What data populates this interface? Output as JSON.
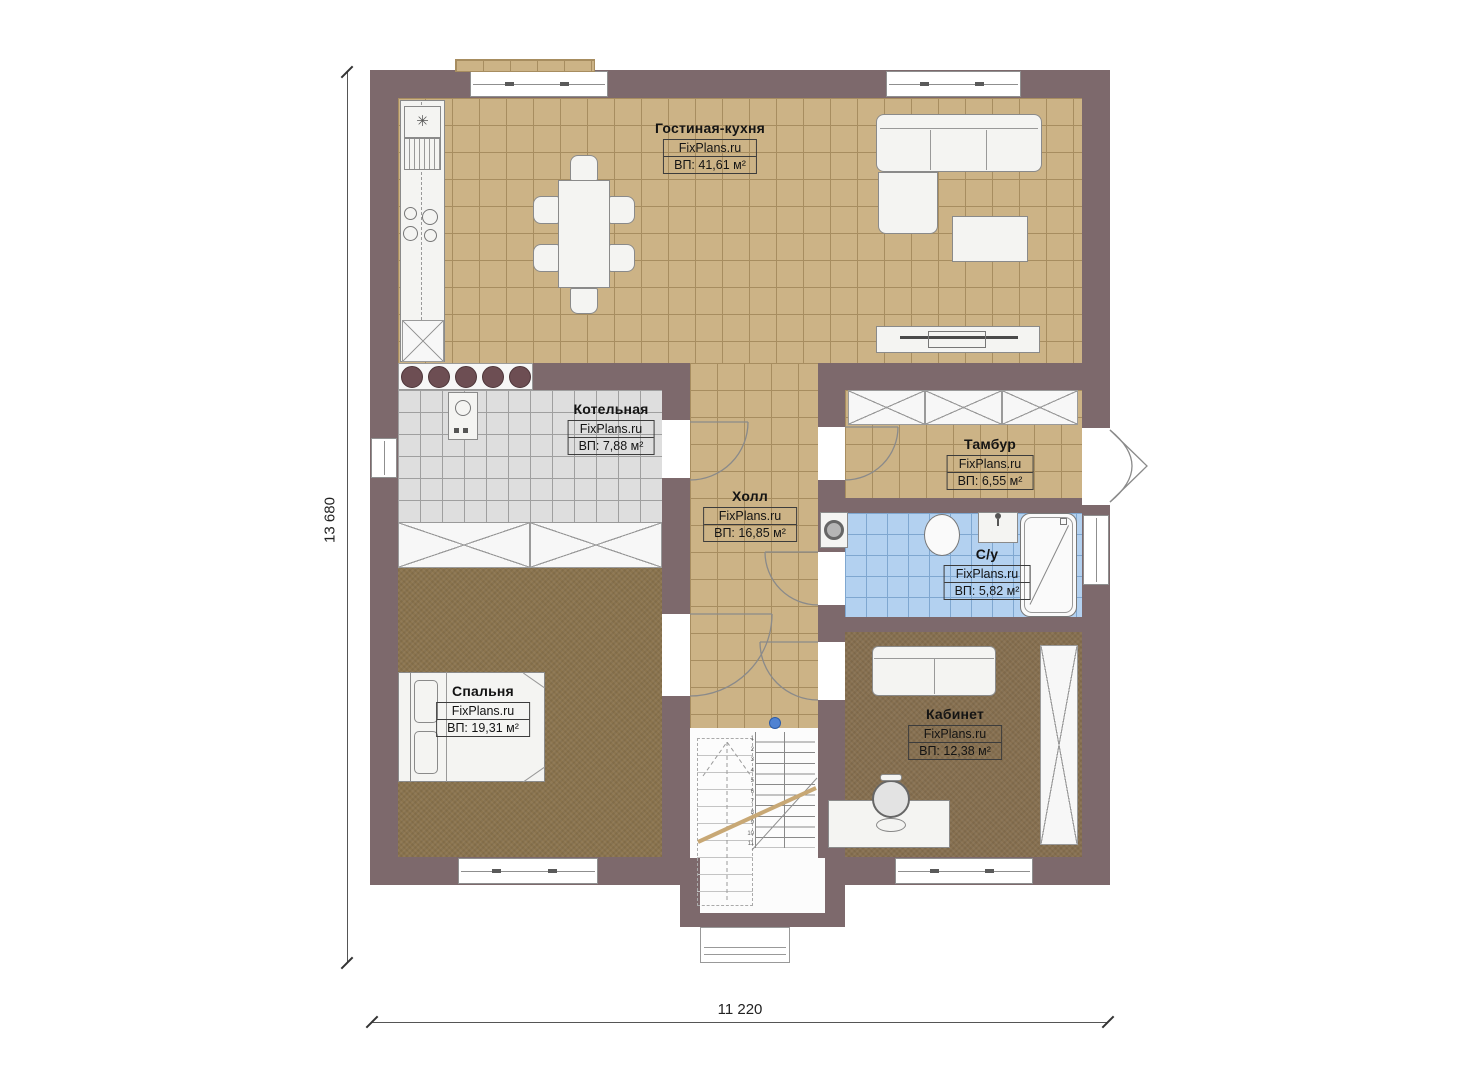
{
  "rooms": {
    "living": {
      "name": "Гостиная-кухня",
      "brand": "FixPlans.ru",
      "area": "ВП: 41,61 м²"
    },
    "boiler": {
      "name": "Котельная",
      "brand": "FixPlans.ru",
      "area": "ВП: 7,88 м²"
    },
    "hall": {
      "name": "Холл",
      "brand": "FixPlans.ru",
      "area": "ВП: 16,85 м²"
    },
    "tambour": {
      "name": "Тамбур",
      "brand": "FixPlans.ru",
      "area": "ВП: 6,55 м²"
    },
    "bathroom": {
      "name": "С/у",
      "brand": "FixPlans.ru",
      "area": "ВП: 5,82 м²"
    },
    "bedroom": {
      "name": "Спальня",
      "brand": "FixPlans.ru",
      "area": "ВП: 19,31 м²"
    },
    "office": {
      "name": "Кабинет",
      "brand": "FixPlans.ru",
      "area": "ВП: 12,38 м²"
    }
  },
  "dimensions": {
    "height_label": "13 680",
    "width_label": "11 220"
  },
  "stairs": {
    "step_numbers": [
      "1",
      "2",
      "3",
      "4",
      "5",
      "6",
      "7",
      "8",
      "9",
      "10",
      "11"
    ]
  },
  "icons": {
    "sink_star": "✳"
  },
  "colors": {
    "wall": "#7d696c",
    "floor-tan": "#ccb386",
    "floor-tan-line": "#a78d60",
    "floor-gray": "#dedede",
    "floor-gray-line": "#9f9f9f",
    "floor-blue": "#b3d1f0",
    "floor-blue-line": "#7fa7d0",
    "carpet-bedroom": "#8b744e",
    "carpet-office": "#877050",
    "fixture-border": "#8a8a8a",
    "stool": "#6d4e53",
    "handrail": "#c8a875",
    "marker-blue": "#4f82d2"
  }
}
